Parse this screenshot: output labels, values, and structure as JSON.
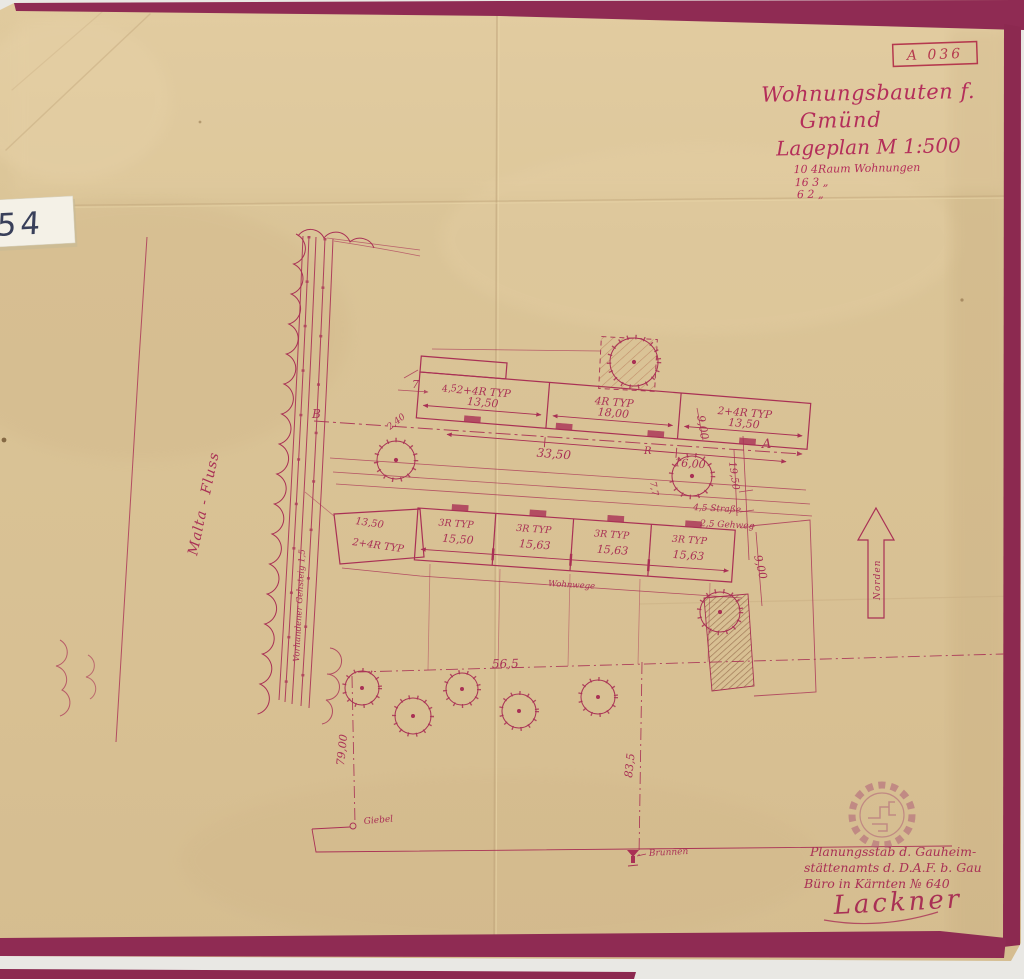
{
  "colors": {
    "paper": "#d9c397",
    "paper_light": "#e4cfa4",
    "tape_border": "#8f2b53",
    "ink": "#a93055",
    "stamp_ink": "#b5394e",
    "label_ink": "#39405a",
    "scan_bed": "#e9e8e4"
  },
  "stamp": {
    "code": "A 036"
  },
  "archive_label": {
    "number": "554"
  },
  "title_block": {
    "line1": "Wohnungsbauten f.",
    "line2": "Gmünd",
    "line3": "Lageplan M 1:500",
    "stat1": "10 4Raum Wohnungen",
    "stat2": "16 3    „",
    "stat3": "6 2    „"
  },
  "plan": {
    "street_label": "Malta - Fluss",
    "sidewalk_label": "Vorhandener Gehsteig 1,5",
    "path_label": "Wohnwege",
    "north_label": "Norden",
    "section_a": "A",
    "section_b": "B",
    "parking_letter": "R",
    "giebel_label": "Giebel",
    "well_label": "Brunnen",
    "upper_building": {
      "unit1_type": "2+4R TYP",
      "unit1_dim": "13,50",
      "unit2_type": "4R TYP",
      "unit2_dim": "18,00",
      "unit3_type": "2+4R TYP",
      "unit3_dim": "13,50",
      "total": "33,50"
    },
    "lower_building": {
      "unit1_type": "2+4R TYP",
      "unit1_dim": "13,50",
      "unit2_type": "3R TYP",
      "unit2_dim": "15,50",
      "unit3_type": "3R TYP",
      "unit3_dim": "15,63",
      "unit4_type": "3R TYP",
      "unit4_dim": "15,63",
      "unit5_type": "3R TYP",
      "unit5_dim": "15,63"
    },
    "dims": {
      "d240": "2,40",
      "d45": "4,5",
      "d7": "7",
      "depth_top": "9,00",
      "tree_dim": "16,00",
      "row_gap": "19,50",
      "street_width": "4,5 Straße",
      "sidewalk_width": "2,5 Gehweg",
      "d77": "7,7",
      "depth_bottom": "9,00",
      "plot_width": "56,5",
      "plot_left": "79,00",
      "plot_right": "83,5"
    }
  },
  "footer": {
    "line1": "Planungsstab d. Gauheim-",
    "line2": "stättenamts d. D.A.F. b. Gau",
    "line3": "Büro in Kärnten   № 640",
    "signature": "Lackner"
  }
}
